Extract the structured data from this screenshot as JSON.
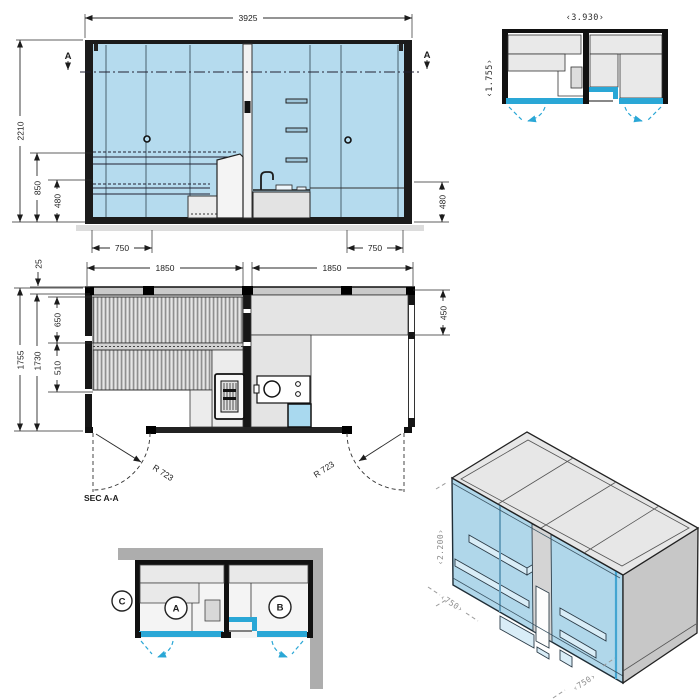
{
  "drawing_title": "modular sauna cabin technical drawing",
  "colors": {
    "glass_blue": "#b5dbee",
    "accent_blue": "#2aa7d6",
    "line_dark": "#1c1c1c",
    "bench_gray": "#e6e6e6",
    "context_wall_gray": "#adadad",
    "shower_blue": "#a9d9ef"
  },
  "views": {
    "elevation": {
      "dim_width": "3925",
      "dim_height": "2210",
      "dim_bench_height": "850",
      "dim_lower_left": "480",
      "dim_door_left": "750",
      "dim_door_right": "750",
      "dim_lower_right": "480",
      "section_marker": "A"
    },
    "plan_overview": {
      "dim_width": "‹3.930›",
      "dim_depth": "‹1.755›"
    },
    "plan_section": {
      "dim_panel": "25",
      "dim_room_left": "1850",
      "dim_room_right": "1850",
      "dim_depth_outer": "1755",
      "dim_depth_inner": "1730",
      "dim_bench_upper": "650",
      "dim_bench_lower": "510",
      "dim_counter": "450",
      "door_radius": "R 723",
      "label": "SEC A-A"
    },
    "plan_context": {
      "marker_a": "A",
      "marker_b": "B",
      "marker_c": "C"
    },
    "isometric": {
      "dim_height": "‹2.200›",
      "dim_depth": "‹750›",
      "dim_width": "‹750›"
    }
  }
}
